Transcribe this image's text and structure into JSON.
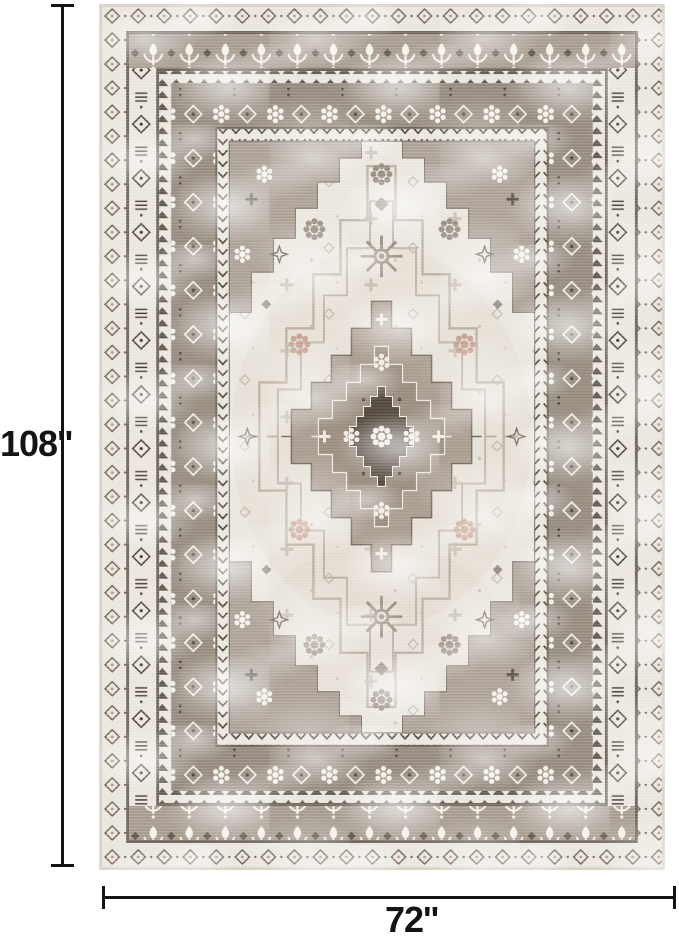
{
  "dimensions": {
    "height_label": "108''",
    "width_label": "72''"
  },
  "rug": {
    "alt": "Distressed vintage oriental area rug in ivory and taupe with layered geometric borders and a stepped center medallion",
    "colors": {
      "ivory": "#eae6de",
      "ivory2": "#f4f1ea",
      "taupe": "#a79c90",
      "taupe2": "#958a7d",
      "taupe3": "#bdb4a8",
      "dark": "#463e34",
      "line": "#6e6459",
      "blush": "#c09584",
      "edge": "#d8d2c6",
      "dim": "#141414"
    }
  }
}
